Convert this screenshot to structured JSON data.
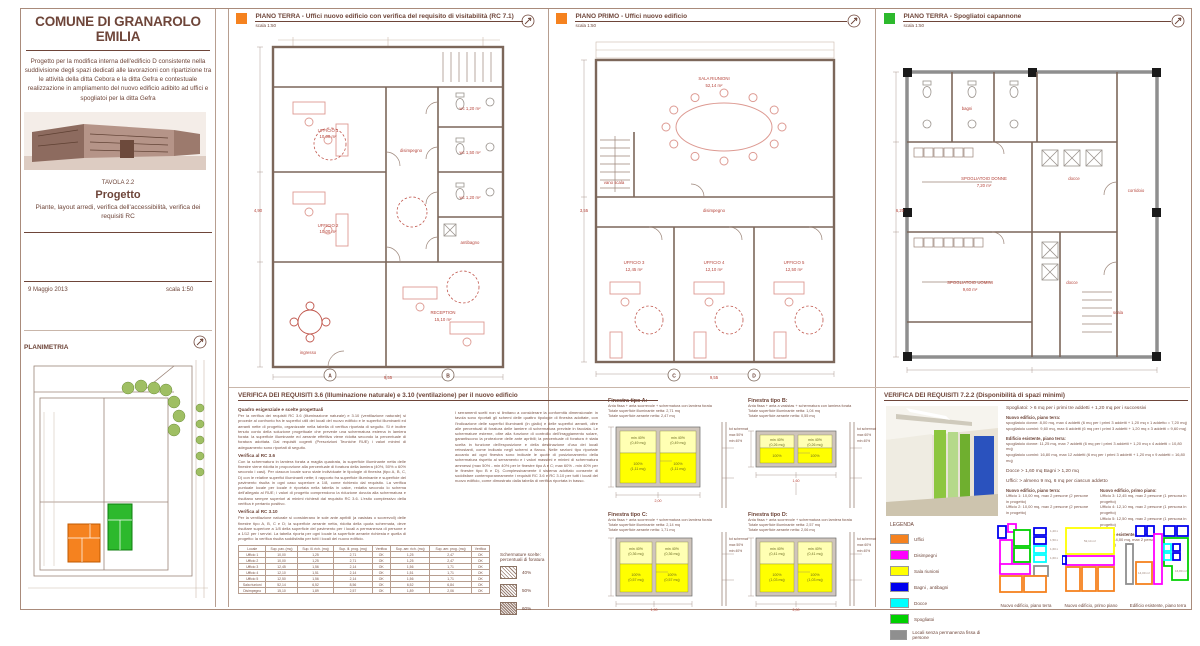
{
  "title_block": {
    "municipality": "COMUNE DI GRANAROLO EMILIA",
    "description": "Progetto per la modifica interna dell'edificio D consistente nella suddivisione degli spazi dedicati alle lavorazioni con ripartizione tra le attività della ditta Cebora e la ditta Gefra e contestuale realizzazione in ampliamento del nuovo edificio adibito ad uffici e spogliatoi per la ditta Gefra",
    "tavola_label": "TAVOLA 2.2",
    "sheet_title": "Progetto",
    "sheet_subtitle": "Piante, layout arredi, verifica dell'accessibilità, verifica dei requisiti RC",
    "date": "9 Maggio 2013",
    "scale": "scala 1:50"
  },
  "planimetria": {
    "title": "PLANIMETRIA",
    "scale": "scala 1:500"
  },
  "plans": [
    {
      "title": "PIANO TERRA - Uffici nuovo edificio con verifica del requisito di visitabilità (RC 7.1)",
      "scale": "scala 1:50",
      "marker_color": "#f5821f",
      "axis": [
        "A",
        "B"
      ],
      "labels": [
        {
          "x": 90,
          "y": 100,
          "t": "UFFICIO 1"
        },
        {
          "x": 90,
          "y": 106,
          "t": "10,00 m²"
        },
        {
          "x": 90,
          "y": 195,
          "t": "UFFICIO 2"
        },
        {
          "x": 90,
          "y": 201,
          "t": "10,00 m²"
        },
        {
          "x": 173,
          "y": 120,
          "t": "disimpegno"
        },
        {
          "x": 232,
          "y": 78,
          "t": "wc 1,20 m²"
        },
        {
          "x": 232,
          "y": 122,
          "t": "wc 1,50 m²"
        },
        {
          "x": 232,
          "y": 167,
          "t": "wc 1,20 m²"
        },
        {
          "x": 232,
          "y": 212,
          "t": "antibagno"
        },
        {
          "x": 205,
          "y": 282,
          "t": "RECEPTION"
        },
        {
          "x": 205,
          "y": 289,
          "t": "15,10 m²"
        },
        {
          "x": 70,
          "y": 322,
          "t": "ingresso"
        },
        {
          "x": 20,
          "y": 180,
          "t": "4,90"
        },
        {
          "x": 150,
          "y": 347,
          "t": "9,55"
        }
      ]
    },
    {
      "title": "PIANO PRIMO - Uffici nuovo edificio",
      "scale": "scala 1:50",
      "marker_color": "#f5821f",
      "axis": [
        "C",
        "D"
      ],
      "labels": [
        {
          "x": 160,
          "y": 48,
          "t": "SALA RIUNIONI"
        },
        {
          "x": 160,
          "y": 55,
          "t": "52,14 m²"
        },
        {
          "x": 60,
          "y": 152,
          "t": "vano scala"
        },
        {
          "x": 80,
          "y": 232,
          "t": "UFFICIO 3"
        },
        {
          "x": 80,
          "y": 239,
          "t": "12,45 m²"
        },
        {
          "x": 160,
          "y": 232,
          "t": "UFFICIO 4"
        },
        {
          "x": 160,
          "y": 239,
          "t": "12,10 m²"
        },
        {
          "x": 240,
          "y": 232,
          "t": "UFFICIO 5"
        },
        {
          "x": 240,
          "y": 239,
          "t": "12,50 m²"
        },
        {
          "x": 160,
          "y": 180,
          "t": "disimpegno"
        },
        {
          "x": 30,
          "y": 180,
          "t": "3,55"
        },
        {
          "x": 160,
          "y": 347,
          "t": "9,55"
        }
      ]
    },
    {
      "title": "PIANO TERRA - Spogliatoi capannone",
      "scale": "scala 1:50",
      "marker_color": "#2db92d",
      "axis": [],
      "labels": [
        {
          "x": 85,
          "y": 78,
          "t": "bagni"
        },
        {
          "x": 102,
          "y": 148,
          "t": "SPOGLIATOIO DONNE"
        },
        {
          "x": 102,
          "y": 155,
          "t": "7,20 m²"
        },
        {
          "x": 192,
          "y": 148,
          "t": "docce"
        },
        {
          "x": 88,
          "y": 252,
          "t": "SPOGLIATOIO UOMINI"
        },
        {
          "x": 88,
          "y": 259,
          "t": "9,60 m²"
        },
        {
          "x": 254,
          "y": 160,
          "t": "corridoio"
        },
        {
          "x": 236,
          "y": 282,
          "t": "scala"
        },
        {
          "x": 190,
          "y": 252,
          "t": "docce"
        },
        {
          "x": 18,
          "y": 180,
          "t": "6,20"
        }
      ]
    }
  ],
  "verifica_36": {
    "title": "VERIFICA DEI REQUISITI 3.6 (Illuminazione naturale) e 3.10 (ventilazione) per il nuovo edificio",
    "intro_heading": "Quadro esigenziale e scelte progettuali",
    "intro_text": "Per la verifica dei requisiti RC 3.6 (illuminazione naturale) e 3.10 (ventilazione naturale) si procede al confronto fra le superfici utili dei locali del nuovo edificio e le superfici illuminanti ed aeranti nette di progetto, organizzate nella tabella di verifica riportata di seguito. Si è inoltre tenuto conto della soluzione progettuale che prevede una schermatura esterna in lamiera forata: la superficie illuminante ed aerante effettiva viene ridotta secondo la percentuale di foratura adottata. Dai requisiti cogenti (Prescrizioni Tecniche RUE) i valori minimi di adeguamento sono riportati di seguito.",
    "rc36_heading": "Verifica al RC 3.6",
    "rc36_text": "Con la schermatura in lamiera forata a maglia quadrata, la superficie illuminante netta delle finestre viene ridotta in proporzione alla percentuale di foratura della lamiera (40%, 50% o 60% secondo i casi). Per ciascun locale sono state individuate le tipologie di finestra (tipo A, B, C, D) con le relative superfici illuminanti nette; il rapporto fra superficie illuminante e superficie del pavimento risulta in ogni caso superiore a 1/8, come richiesto dal requisito. La verifica puntuale locale per locale è riportata nella tabella in calce, redatta secondo lo schema dell'allegato al RUE; i valori di progetto comprendono la riduzione dovuta alla schermatura e risultano sempre superiori ai minimi richiesti dal requisito RC 3.6. L'esito complessivo della verifica è pertanto positivo.",
    "rc310_heading": "Verifica al RC 3.10",
    "rc310_text": "Per la ventilazione naturale si considerano le sole ante apribili (a vasistas o scorrevoli) delle finestre tipo A, B, C e D; la superficie aerante netta, ridotta della quota schermata, deve risultare superiore a 1/8 della superficie del pavimento per i locali a permanenza di persone e a 1/12 per i servizi. La tabella riporta per ogni locale la superficie aerante richiesta e quella di progetto: la verifica risulta soddisfatta per tutti i locali del nuovo edificio.",
    "col2_text": "I serramenti scelti non si limitano a considerare la conformità dimensionale: in tavola sono riportati gli schemi delle quattro tipologie di finestra adottate, con l'indicazione delle superfici illuminanti (in giallo) e delle superfici aeranti, oltre alle percentuali di foratura delle lamiere di schermatura previste in facciata. Le schermature esterne, oltre alla funzione di controllo dell'irraggiamento solare, garantiscono la protezione delle ante apribili; la percentuale di foratura è stata scelta in funzione dell'esposizione e della destinazione d'uso dei locali retrostanti, come indicato negli schemi a fianco. Nelle sezioni tipo riportate accanto ad ogni finestra sono indicate le quote di posizionamento della schermatura rispetto al serramento e i valori massimi e minimi di schermatura ammessi (max 50% - min 40% per le finestre tipo A e C; max 60% - min 40% per le finestre tipo B e D). Complessivamente il sistema adottato consente di soddisfare contemporaneamente i requisiti RC 3.6 e RC 3.10 per tutti i locali del nuovo edificio, come dimostrato dalla tabella di verifica riportata in basso.",
    "schermature": {
      "title1": "Schermature scelte:",
      "title2": "percentuali di foratura",
      "items": [
        "40%",
        "50%",
        "60%"
      ]
    },
    "table": {
      "headers": [
        "Locale",
        "Sup. pav. (mq)",
        "Sup. ill. rich. (mq)",
        "Sup. ill. prog. (mq)",
        "Verifica",
        "Sup. aer. rich. (mq)",
        "Sup. aer. prog. (mq)",
        "Verifica"
      ],
      "rows": [
        [
          "Ufficio 1",
          "10,00",
          "1,25",
          "2,71",
          "OK",
          "1,25",
          "2,47",
          "OK"
        ],
        [
          "Ufficio 2",
          "10,00",
          "1,25",
          "2,71",
          "OK",
          "1,25",
          "2,47",
          "OK"
        ],
        [
          "Ufficio 3",
          "12,45",
          "1,56",
          "2,14",
          "OK",
          "1,56",
          "1,71",
          "OK"
        ],
        [
          "Ufficio 4",
          "12,10",
          "1,51",
          "2,14",
          "OK",
          "1,51",
          "1,71",
          "OK"
        ],
        [
          "Ufficio 5",
          "12,50",
          "1,56",
          "2,14",
          "OK",
          "1,56",
          "1,71",
          "OK"
        ],
        [
          "Sala riunioni",
          "52,14",
          "6,52",
          "8,56",
          "OK",
          "6,52",
          "6,84",
          "OK"
        ],
        [
          "Disimpegno",
          "15,10",
          "1,89",
          "2,57",
          "OK",
          "1,89",
          "2,06",
          "OK"
        ]
      ]
    },
    "finestre": [
      {
        "name": "Finestra tipo A:",
        "line1": "Anta fissa + anta scorrevole + schermatura con lamiera forata",
        "line2": "Totale superficie illuminante netta: 2,71 mq",
        "line3": "Totale superficie aerante netta: 2,47 mq",
        "top_label": "min 40%",
        "top_area": "(0,49 mq)",
        "bottom_label": "100%",
        "bottom_area": "(1,11 mq)",
        "width_dim": "2,00",
        "note1": "tot schermatura",
        "note2": "max 50%",
        "note3": "min 40%"
      },
      {
        "name": "Finestra tipo B:",
        "line1": "Anta fissa + anta a vasistas + schermatura con lamiera forata",
        "line2": "Totale superficie illuminante netta: 1,04 mq",
        "line3": "Totale superficie aerante netta: 0,55 mq",
        "top_label": "min 40%",
        "top_area": "(0,26 mq)",
        "bottom_label": "100%",
        "bottom_area": "(0,26 mq)",
        "width_dim": "1,60",
        "note1": "tot schermatura",
        "note2": "max 60%",
        "note3": "min 40%"
      },
      {
        "name": "Finestra tipo C:",
        "line1": "Anta fissa + anta scorrevole + schermatura con lamiera forata",
        "line2": "Totale superficie illuminante netta: 2,14 mq",
        "line3": "Totale superficie aerante netta: 1,71 mq",
        "top_label": "min 40%",
        "top_area": "(0,36 mq)",
        "bottom_label": "100%",
        "bottom_area": "(0,57 mq)",
        "width_dim": "1,90",
        "note1": "tot schermatura",
        "note2": "max 50%",
        "note3": "min 40%"
      },
      {
        "name": "Finestra tipo D:",
        "line1": "Anta fissa + anta scorrevole + schermatura con lamiera forata",
        "line2": "Totale superficie illuminante netta: 2,57 mq",
        "line3": "Totale superficie aerante netta: 2,06 mq",
        "top_label": "min 40%",
        "top_area": "(0,41 mq)",
        "bottom_label": "100%",
        "bottom_area": "(1,03 mq)",
        "width_dim": "2,00",
        "note1": "tot schermatura",
        "note2": "max 60%",
        "note3": "min 40%"
      }
    ]
  },
  "verifica_722": {
    "title": "VERIFICA DEI REQUISITI 7.2.2 (Disponibilità di spazi minimi)",
    "intro": "Spogliatoi: > 6 mq per i primi tre addetti + 1,20 mq per i successivi",
    "nuovo_pt_head": "Nuovo edificio, piano terra:",
    "npt1": "spogliatoio donne: 8,00 mq, max 4 addetti (6 mq per i primi 3 addetti + 1,20 mq x 1 addetto = 7,20 mq)",
    "npt2": "spogliatoio uomini: 9,60 mq, max 6 addetti (6 mq per i primi 3 addetti + 1,20 mq x 3 addetti = 9,60 mq)",
    "esist_head": "Edificio esistente, piano terra:",
    "e1": "spogliatoio donne: 11,25 mq, max 7 addetti (6 mq per i primi 3 addetti + 1,20 mq x 4 addetti = 10,80 mq)",
    "e2": "spogliatoio uomini: 16,80 mq, max 12 addetti (6 mq per i primi 3 addetti + 1,20 mq x 9 addetti = 16,80 mq)",
    "docce_bagni": "Docce > 1,60 mq    Bagni > 1,20 mq",
    "uffici_intro": "Uffici: > almeno 9 mq, 6 mq per ciascun addetto",
    "colA_head": "Nuovo edificio, piano terra:",
    "a1": "Ufficio 1: 10,00 mq, max 2 persone (2 persone in progetto)",
    "a2": "Ufficio 2: 10,00 mq, max 2 persone (2 persone in progetto)",
    "colB_head": "Nuovo edificio, primo piano:",
    "b1": "Ufficio 3: 12,45 mq, max 2 persone (1 persona in progetto)",
    "b2": "Ufficio 4: 12,10 mq, max 2 persone (1 persona in progetto)",
    "b3": "Ufficio 5: 12,50 mq, max 2 persone (1 persona in progetto)",
    "colC_head": "Edificio esistente, piano terra:",
    "c1": "Ufficio: 14,00 mq, max 2 persone (2 persone in progetto)",
    "legend": {
      "title": "LEGENDA",
      "items": [
        {
          "label": "Uffici",
          "color": "#f5821f"
        },
        {
          "label": "Disimpegni",
          "color": "#ff00ff"
        },
        {
          "label": "Sala riunioni",
          "color": "#ffff00"
        },
        {
          "label": "Bagni , antibagni",
          "color": "#0000ee"
        },
        {
          "label": "Docce",
          "color": "#00ffff"
        },
        {
          "label": "Spogliatoi",
          "color": "#00d000"
        },
        {
          "label": "Locali senza permanenza fissa di persone",
          "color": "#8f8f8f"
        }
      ]
    },
    "mini_plans": [
      {
        "caption": "Nuovo edificio, piano terra"
      },
      {
        "caption": "Nuovo edificio, primo piano"
      },
      {
        "caption": "Edificio esistente, piano terra"
      }
    ]
  }
}
